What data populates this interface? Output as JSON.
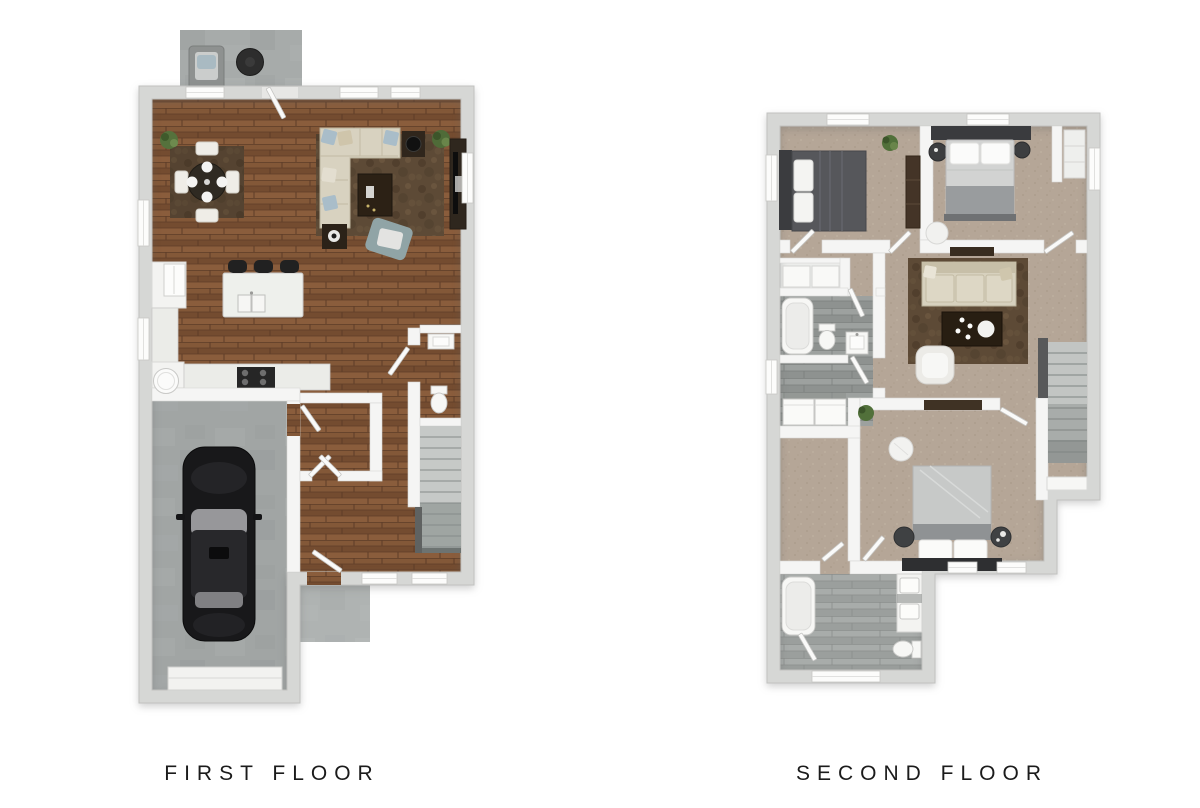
{
  "page": {
    "background": "#ffffff",
    "width": 1200,
    "height": 808,
    "type": "3d-floor-plan"
  },
  "plans": {
    "first": {
      "label": "FIRST FLOOR",
      "rooms": [
        "patio",
        "dining-area",
        "living-room",
        "kitchen",
        "garage",
        "powder-room",
        "entry-hall",
        "stairs",
        "entry-stoop"
      ],
      "furniture": [
        "patio-lounge-chair",
        "patio-round-table",
        "dining-table-with-4-chairs",
        "dining-rug",
        "sectional-sofa",
        "living-rug",
        "coffee-table",
        "side-tables",
        "tv-console",
        "floor-cushion",
        "kitchen-island-with-sink",
        "bar-stools-x3",
        "refrigerator",
        "pantry-cabinet",
        "range",
        "counters",
        "black-car",
        "water-heater",
        "toilet",
        "powder-sink",
        "plants"
      ]
    },
    "second": {
      "label": "SECOND FLOOR",
      "rooms": [
        "bedroom-2",
        "bedroom-3",
        "closet-nook",
        "loft",
        "hall-bathroom",
        "linen-closet",
        "laundry",
        "walk-in-closet",
        "master-bedroom",
        "master-bathroom",
        "stairs"
      ],
      "furniture": [
        "dark-bed",
        "light-bed",
        "master-bed",
        "nightstands",
        "dressers",
        "loft-sofa",
        "loft-rug",
        "loft-coffee-table",
        "armchair",
        "media-console",
        "washer-dryer",
        "bathtub-x2",
        "double-vanity",
        "toilets",
        "sinks",
        "poufs",
        "plants"
      ]
    }
  },
  "colors": {
    "wood_floor": "#7d5335",
    "carpet": "#b5a697",
    "tile": "#969a98",
    "concrete": "#a7abaa",
    "rug": "#5d4a36",
    "exterior_wall": "#d6d7d5",
    "interior_wall": "#f5f5f4",
    "sofa_beige": "#d7d1be",
    "car_black": "#18181a",
    "label_text": "#1b1b1b"
  }
}
